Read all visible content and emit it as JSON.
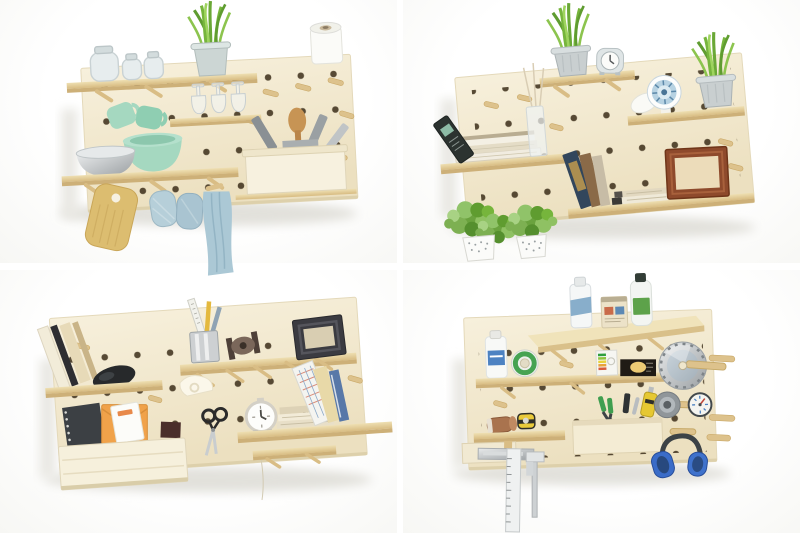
{
  "collage": {
    "layout": "2x2-photo-grid",
    "gutter_color": "#ffffff",
    "photo_background": "#fcfcfa"
  },
  "palette": {
    "board_cream": "#f5eed8",
    "board_cream_deep": "#eadfbf",
    "peg_hole_brown": "#41331f",
    "wood_tan": "#e7d3a0",
    "wood_tan_edge": "#cdb078",
    "mint_green": "#a5d8c0",
    "mint_green_deep": "#8fceb2",
    "steel_gray": "#b7bbbd",
    "towel_blue": "#abc8d5",
    "mitt_blue": "#b6cfd9",
    "plant_green": "#76b53c",
    "plant_green_deep": "#5f9c30",
    "foliage_green": "#7db052",
    "bucket_silver": "#ccd6d4",
    "ornament_blue": "#b7d2e2",
    "frame_brown": "#8e4a2c",
    "frame_black": "#3b3b41",
    "envelope_orange": "#f0a24a",
    "notebook_dark": "#3c4044",
    "tool_yellow": "#e6c832",
    "label_blue": "#4d82c2",
    "label_green": "#5da24a",
    "tape_green": "#46a352",
    "headset_blue": "#3a6cc8",
    "soft_shadow": "#e0dfda"
  },
  "panels": [
    {
      "id": "kitchen",
      "position": "top-left",
      "items": [
        "potted-grass-plant",
        "glass-jars",
        "paper-towel-roll",
        "wine-glasses",
        "mint-mugs",
        "mint-bowl",
        "steel-bowl",
        "utensil-crock",
        "wooden-shelves",
        "cutting-board",
        "oven-mitts",
        "hanging-towel",
        "wooden-pegs"
      ]
    },
    {
      "id": "living-room",
      "position": "top-right",
      "items": [
        "potted-grass-plant",
        "alarm-clock",
        "ornament-plate",
        "second-potted-plant",
        "book-stack",
        "chalkboard-book",
        "glass-vase",
        "leaning-books",
        "book-pile",
        "wood-picture-frame",
        "hanging-planters",
        "wooden-pegs"
      ]
    },
    {
      "id": "home-office",
      "position": "bottom-left",
      "items": [
        "leaning-binders",
        "computer-mouse",
        "ruler-and-pencil-cup",
        "twine-spool",
        "black-picture-frame",
        "paper-bin",
        "spiral-notebook",
        "orange-envelope",
        "white-notepad",
        "scissors",
        "desk-clock",
        "office-book-stack",
        "leaning-notebooks",
        "wooden-pegs"
      ]
    },
    {
      "id": "workshop",
      "position": "bottom-right",
      "items": [
        "spray-can",
        "paint-can",
        "solvent-bottle",
        "cleaner-bottle",
        "green-tape-roll",
        "bulb-boxes",
        "saw-blade",
        "utility-knife",
        "grey-tape-roll",
        "round-gauge",
        "sandpaper-roll",
        "tape-measure",
        "tool-box",
        "pliers",
        "carpenter-square",
        "caliper",
        "ear-defenders",
        "wooden-pegs"
      ]
    }
  ]
}
